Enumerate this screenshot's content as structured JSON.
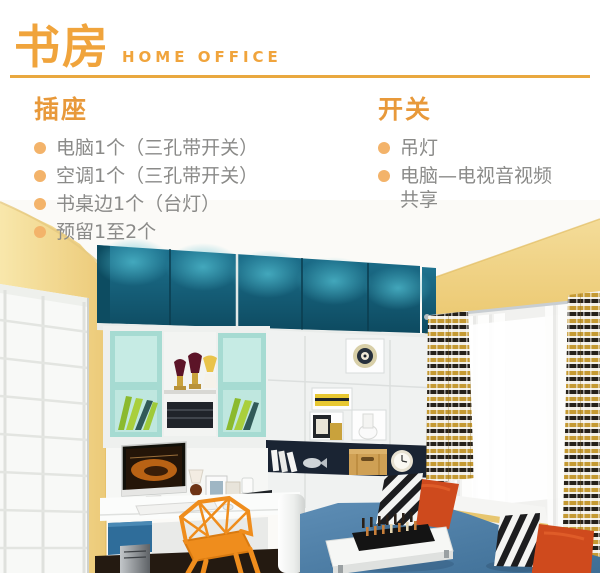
{
  "header": {
    "title_cn": "书房",
    "title_en": "HOME OFFICE"
  },
  "outlets": {
    "heading": "插座",
    "items": [
      "电脑1个（三孔带开关）",
      "空调1个（三孔带开关）",
      "书桌边1个（台灯）",
      "预留1至2个"
    ]
  },
  "switches": {
    "heading": "开关",
    "items": [
      "吊灯",
      "电脑—电视音视频共享"
    ]
  },
  "palette": {
    "accent_orange": "#F0A43C",
    "rule_orange": "#E9A83F",
    "heading_orange": "#E8993A",
    "bullet_orange": "#F3B36A",
    "body_text_gray": "#8A8A88",
    "wall_yellow": "#F0D285",
    "cabinet_teal": "#16607A",
    "shelf_mint": "#A6DBD2",
    "book_green": "#9FCA39",
    "shelf_navy": "#1A2433",
    "platform_blue": "#4E81AA",
    "pillow_orange": "#CF4A1D",
    "chair_orange": "#EF8D1D"
  }
}
